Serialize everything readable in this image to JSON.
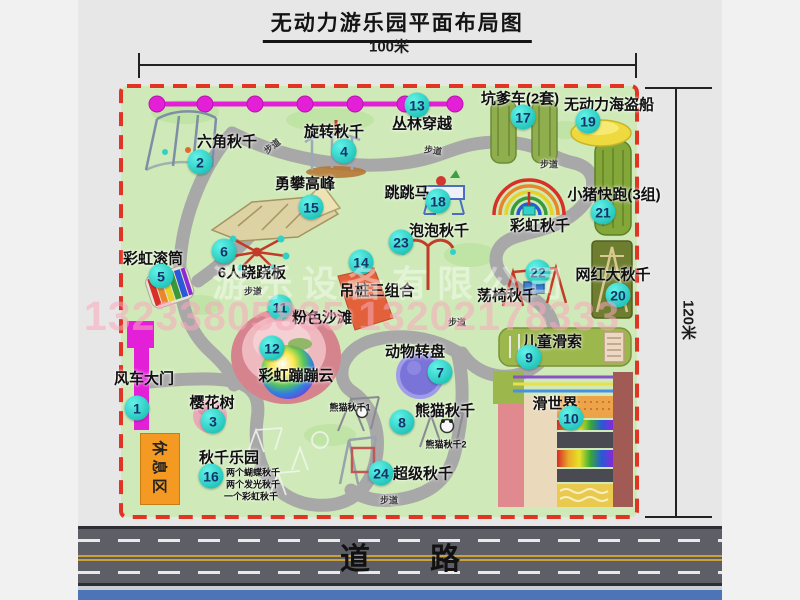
{
  "title": "无动力游乐园平面布局图",
  "dimensions": {
    "top": "100米",
    "right": "120米"
  },
  "road": {
    "label_left": "道",
    "label_right": "路"
  },
  "watermark": {
    "company": "游乐设备有限公司",
    "phone": "13233805835 13202178333"
  },
  "park": {
    "rest_area_label": "休息区",
    "path_label_text": "步道",
    "items": [
      {
        "num": 1,
        "label": "风车大门",
        "mx": 137,
        "my": 408,
        "lx": 144,
        "ly": 378
      },
      {
        "num": 2,
        "label": "六角秋千",
        "mx": 200,
        "my": 162,
        "lx": 227,
        "ly": 141
      },
      {
        "num": 3,
        "label": "樱花树",
        "mx": 213,
        "my": 421,
        "lx": 212,
        "ly": 402
      },
      {
        "num": 4,
        "label": "旋转秋千",
        "mx": 344,
        "my": 151,
        "lx": 334,
        "ly": 131
      },
      {
        "num": 5,
        "label": "彩虹滚筒",
        "mx": 161,
        "my": 276,
        "lx": 153,
        "ly": 258
      },
      {
        "num": 6,
        "label": "6人跷跷板",
        "mx": 224,
        "my": 251,
        "lx": 252,
        "ly": 272
      },
      {
        "num": 7,
        "label": "动物转盘",
        "mx": 440,
        "my": 372,
        "lx": 415,
        "ly": 351
      },
      {
        "num": 8,
        "label": "熊猫秋千",
        "mx": 402,
        "my": 422,
        "lx": 445,
        "ly": 410
      },
      {
        "num": 9,
        "label": "儿童滑索",
        "mx": 529,
        "my": 357,
        "lx": 552,
        "ly": 341
      },
      {
        "num": 10,
        "label": "滑世界",
        "mx": 571,
        "my": 418,
        "lx": 555,
        "ly": 403
      },
      {
        "num": 11,
        "label": "粉色沙滩",
        "mx": 280,
        "my": 307,
        "lx": 322,
        "ly": 317
      },
      {
        "num": 12,
        "label": "彩虹蹦蹦云",
        "mx": 272,
        "my": 348,
        "lx": 296,
        "ly": 375
      },
      {
        "num": 13,
        "label": "丛林穿越",
        "mx": 417,
        "my": 105,
        "lx": 422,
        "ly": 123
      },
      {
        "num": 14,
        "label": "吊桩三组合",
        "mx": 361,
        "my": 262,
        "lx": 377,
        "ly": 290
      },
      {
        "num": 15,
        "label": "勇攀高峰",
        "mx": 311,
        "my": 207,
        "lx": 305,
        "ly": 183
      },
      {
        "num": 16,
        "label": "秋千乐园",
        "mx": 211,
        "my": 476,
        "lx": 229,
        "ly": 457
      },
      {
        "num": 17,
        "label": "坑爹车(2套)",
        "mx": 523,
        "my": 117,
        "lx": 520,
        "ly": 98
      },
      {
        "num": 18,
        "label": "跳跳马",
        "mx": 438,
        "my": 201,
        "lx": 407,
        "ly": 192
      },
      {
        "num": 19,
        "label": "无动力海盗船",
        "mx": 588,
        "my": 121,
        "lx": 609,
        "ly": 104
      },
      {
        "num": 20,
        "label": "网红大秋千",
        "mx": 618,
        "my": 295,
        "lx": 613,
        "ly": 274
      },
      {
        "num": 21,
        "label": "小猪快跑(3组)",
        "mx": 603,
        "my": 212,
        "lx": 614,
        "ly": 194
      },
      {
        "num": 22,
        "label": "荡椅秋千",
        "mx": 538,
        "my": 272,
        "lx": 507,
        "ly": 295
      },
      {
        "num": 23,
        "label": "泡泡秋千",
        "mx": 401,
        "my": 242,
        "lx": 439,
        "ly": 230
      },
      {
        "num": 24,
        "label": "超级秋千",
        "mx": 381,
        "my": 473,
        "lx": 423,
        "ly": 473
      }
    ],
    "extra_labels": [
      {
        "text": "彩虹秋千",
        "x": 540,
        "y": 225,
        "size": 15
      },
      {
        "text": "熊猫秋千1",
        "x": 350,
        "y": 407,
        "size": 9
      },
      {
        "text": "熊猫秋千2",
        "x": 446,
        "y": 444,
        "size": 9
      },
      {
        "text": "两个蝴蝶秋千",
        "x": 253,
        "y": 472,
        "size": 9
      },
      {
        "text": "两个发光秋千",
        "x": 253,
        "y": 484,
        "size": 9
      },
      {
        "text": "一个彩虹秋千",
        "x": 251,
        "y": 496,
        "size": 9
      }
    ],
    "path_labels": [
      {
        "x": 272,
        "y": 146,
        "rot": -38
      },
      {
        "x": 433,
        "y": 150,
        "rot": 8
      },
      {
        "x": 549,
        "y": 164,
        "rot": 0
      },
      {
        "x": 253,
        "y": 291,
        "rot": 0
      },
      {
        "x": 457,
        "y": 322,
        "rot": 0
      },
      {
        "x": 389,
        "y": 500,
        "rot": 0
      }
    ]
  },
  "colors": {
    "marker_teal": "#2fd2c8",
    "border_red": "#e03425",
    "ground_green": "#cfeab8",
    "gate_magenta": "#e41fd8",
    "rest_orange": "#f49a22",
    "road_grey": "#5e5e66"
  }
}
